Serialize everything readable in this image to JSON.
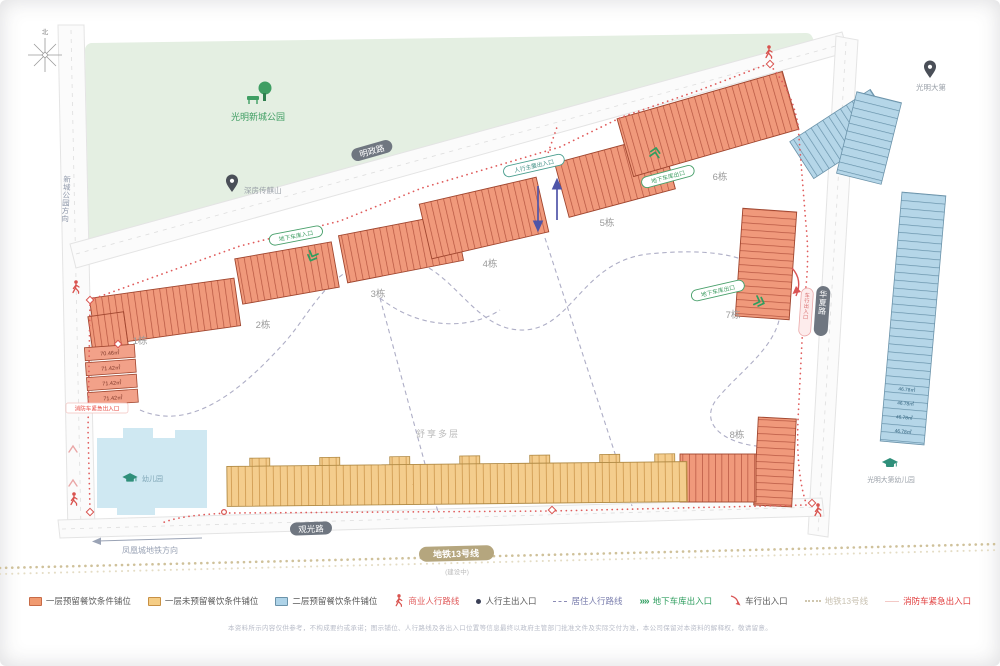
{
  "map": {
    "compass_north": "北",
    "park_name": "光明新城公园",
    "pin_project": "深房传麒山",
    "pin_east": "光明大第",
    "kindergarten_site": "幼儿园",
    "kindergarten_east": "光明大第幼儿园",
    "road_north": "明政路",
    "road_south": "观光路",
    "road_east": "华夏路",
    "dir_west": "新城公园方向",
    "dir_southwest": "凤凰城地铁方向",
    "metro_label": "地铁13号线",
    "metro_status": "(建设中)",
    "center_note": "舒享多层",
    "buildings": [
      "1栋",
      "2栋",
      "3栋",
      "4栋",
      "5栋",
      "6栋",
      "7栋",
      "8栋"
    ],
    "cap_main_entrance": "人行主要出入口",
    "cap_garage_in": "地下车库入口",
    "cap_garage_out_a": "地下车库出口",
    "cap_garage_out_b": "地下车库出口",
    "cap_vehicle": "车行出入口",
    "fire_exit": "消防车紧急出入口",
    "areas_left": [
      "70.46㎡",
      "71.42㎡",
      "71.42㎡",
      "71.42㎡"
    ],
    "areas_right": [
      "46.78㎡",
      "46.78㎡",
      "46.78㎡",
      "46.78㎡"
    ]
  },
  "legend": {
    "items": [
      {
        "label": "一层预留餐饮条件铺位",
        "color": "#f09a70"
      },
      {
        "label": "一层未预留餐饮条件铺位",
        "color": "#f5cd85"
      },
      {
        "label": "二层预留餐饮条件铺位",
        "color": "#aed3e8"
      },
      {
        "label": "商业人行路线",
        "color": "#e05c5c"
      },
      {
        "label": "人行主出入口",
        "color": "#3a3f56"
      },
      {
        "label": "居住人行路线",
        "color": "#8b8bb5"
      },
      {
        "label": "地下车库出入口",
        "color": "#2f9e5f"
      },
      {
        "label": "车行出入口",
        "color": "#d95454"
      },
      {
        "label": "地铁13号线",
        "color": "#cfc6ae"
      },
      {
        "label": "消防车紧急出入口",
        "color": "#e03b3b"
      }
    ]
  },
  "disclaimer": "本资料所示内容仅供参考，不构成要约或承诺；图示铺位、人行路线及各出入口位置等信息最终以政府主管部门批准文件及实际交付为准，本公司保留对本资料的解释权，敬请留意。"
}
